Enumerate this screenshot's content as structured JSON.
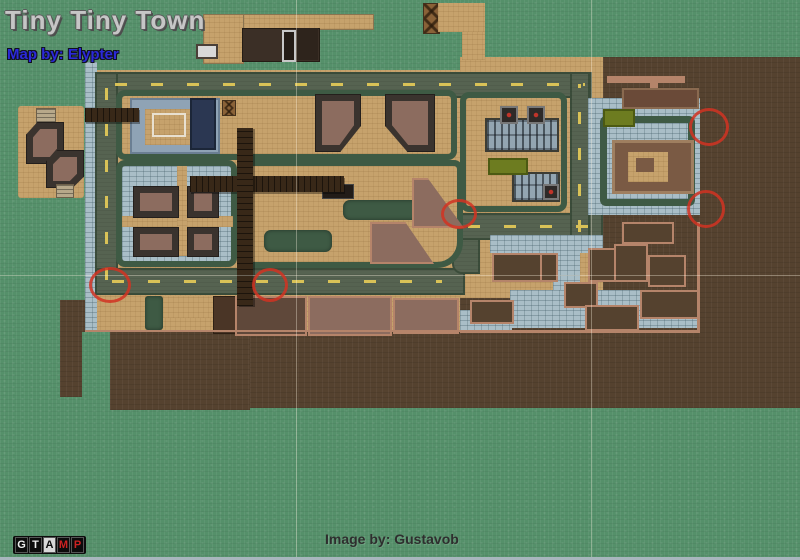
{
  "title": "Tiny Tiny Town",
  "credits": {
    "map_by": "Map by: Elypter",
    "image_by": "Image by: Gustavob"
  },
  "logo": {
    "letters": [
      "G",
      "T",
      "A",
      "M",
      "P"
    ]
  },
  "markers": [
    {
      "cx": 107,
      "cy": 282,
      "rx": 18,
      "ry": 15
    },
    {
      "cx": 267,
      "cy": 282,
      "rx": 15,
      "ry": 14
    },
    {
      "cx": 456,
      "cy": 211,
      "rx": 15,
      "ry": 12
    },
    {
      "cx": 706,
      "cy": 124,
      "rx": 17,
      "ry": 16
    },
    {
      "cx": 703,
      "cy": 206,
      "rx": 16,
      "ry": 16
    }
  ],
  "colors": {
    "grass": "#55906a",
    "dirt": "#55422f",
    "sand": "#c6a26c",
    "cobble": "#a9bec7",
    "hedge": "#3e5a44",
    "road": "#566351",
    "road_line": "#d9c257",
    "pier": "#382818",
    "salmon": "#b5846a",
    "mauve": "#8c6c5f",
    "dark": "#3a332e",
    "navy": "#2b3752",
    "olive": "#6d7c20",
    "slate": "#8fa3b5",
    "marker": "#d23222",
    "title_text": "#c6c6c6",
    "credit_blue": "#2b29d8",
    "credit_dark": "#2e2e2e",
    "logo_red": "#cc2222"
  }
}
